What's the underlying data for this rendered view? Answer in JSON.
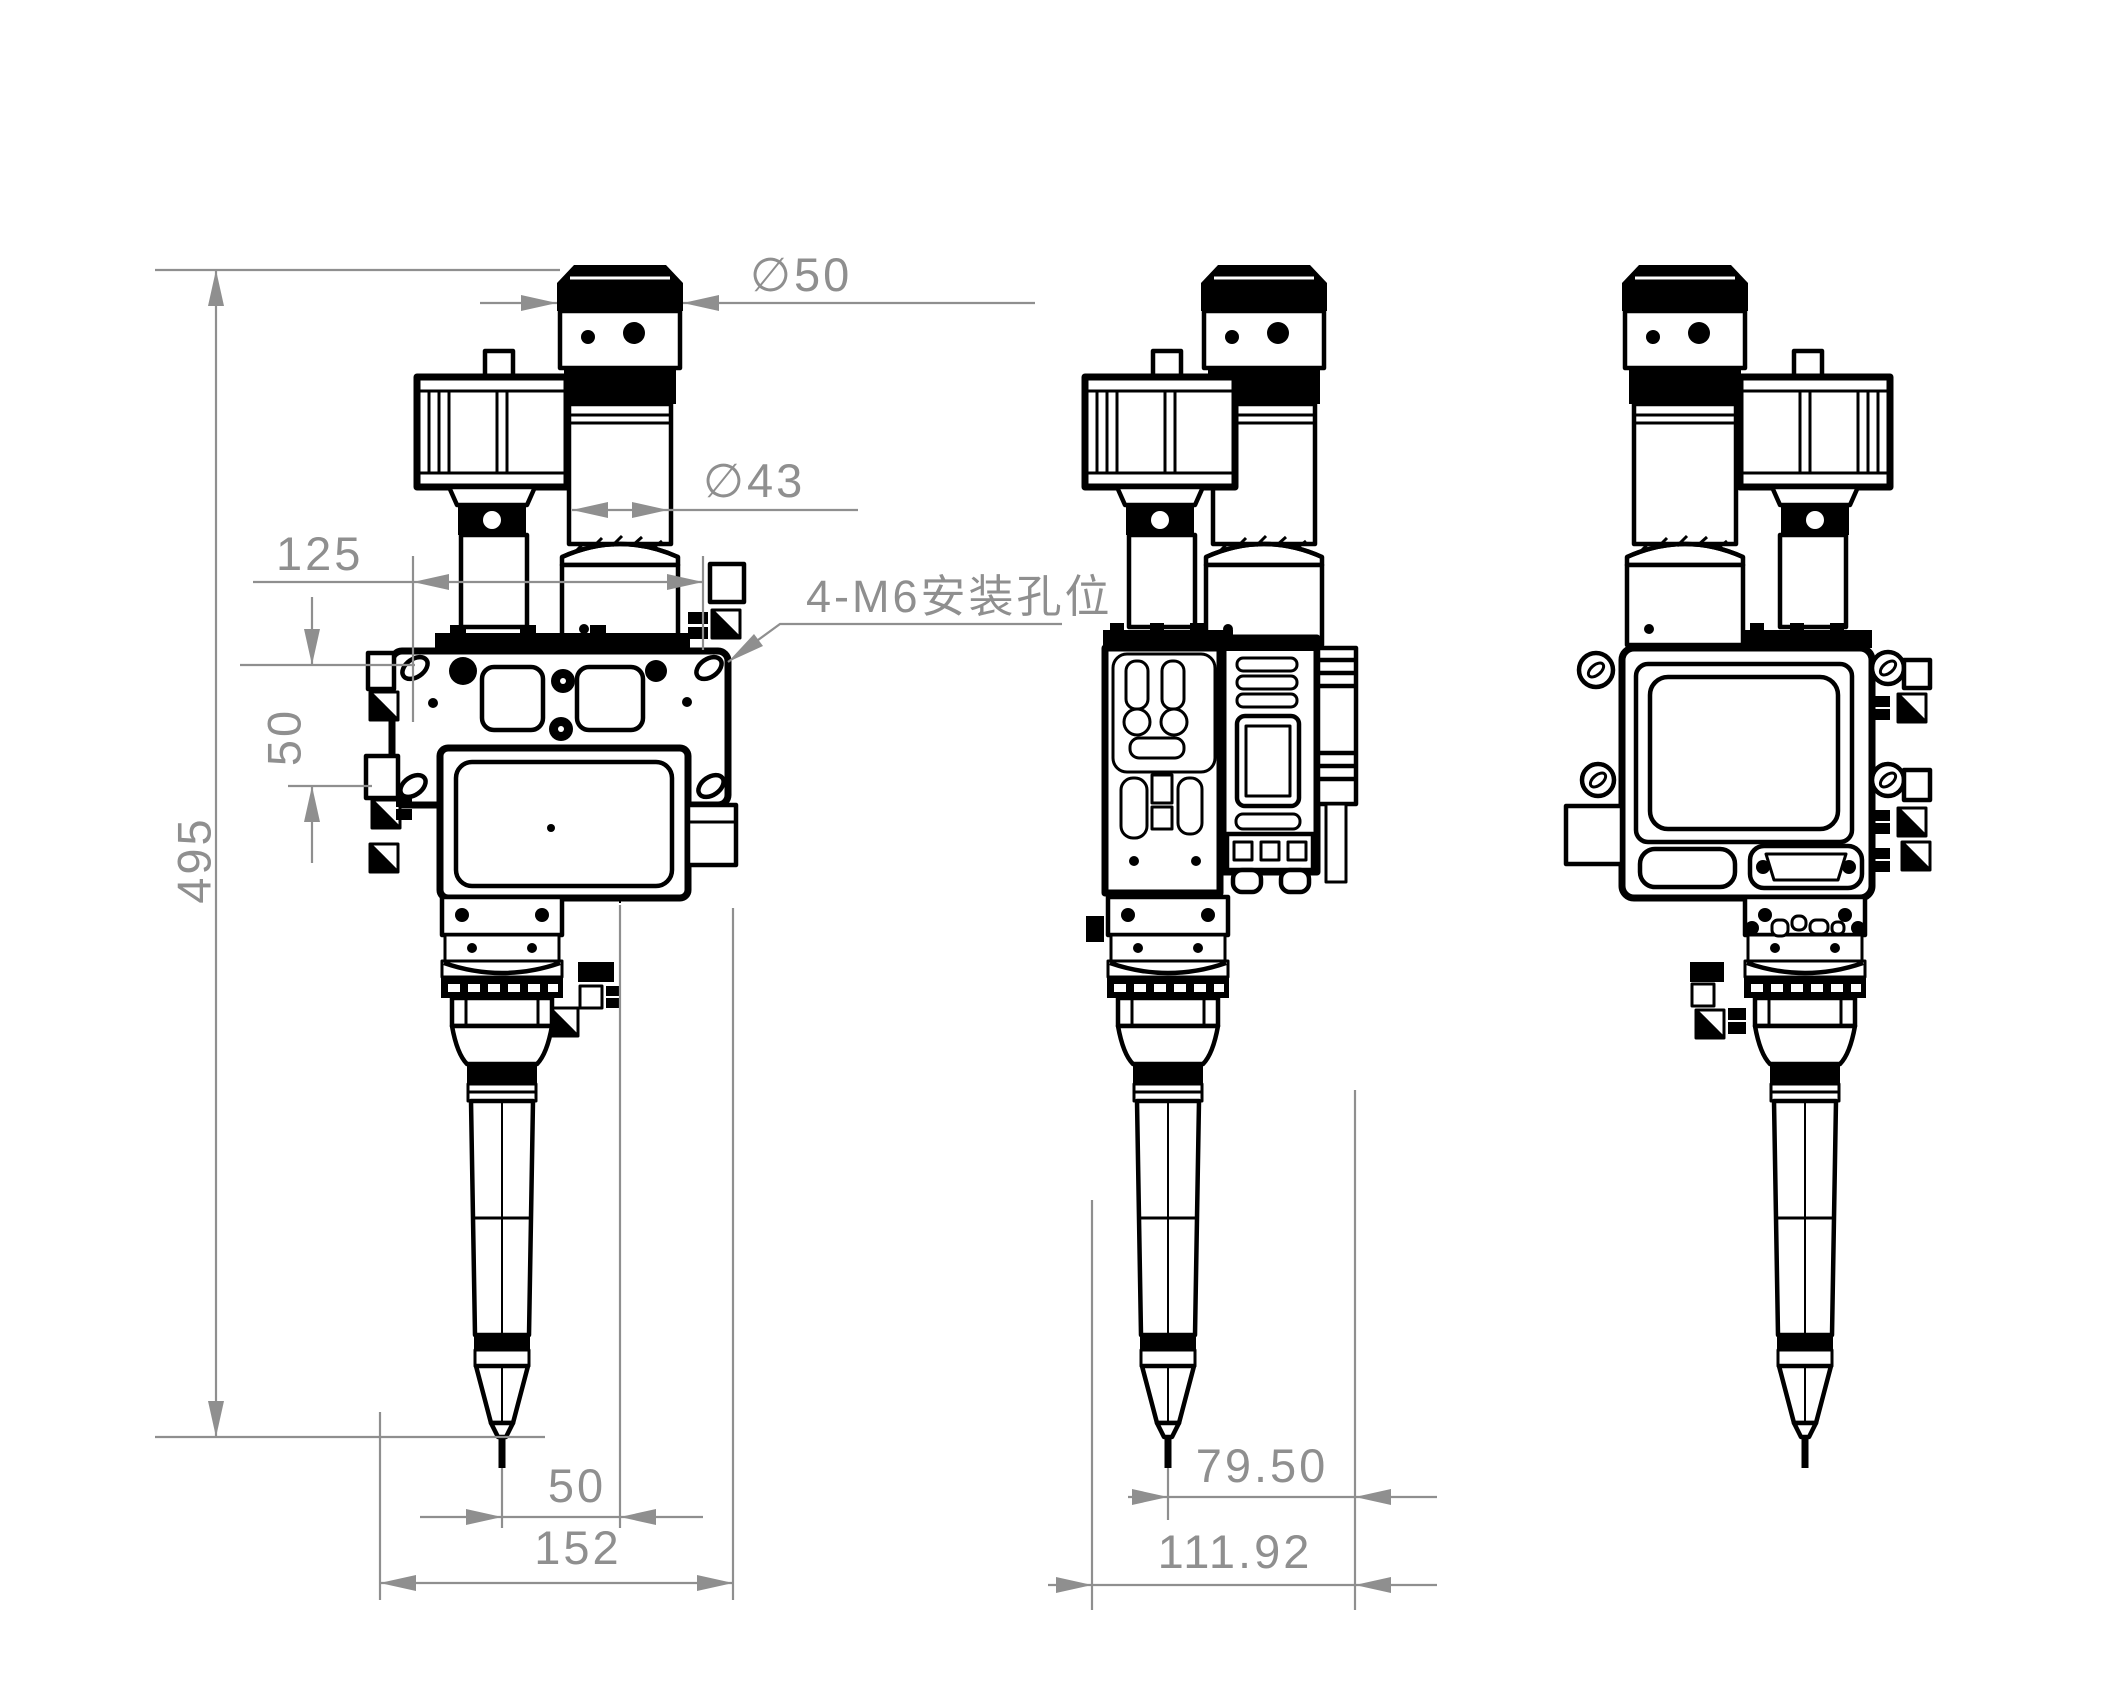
{
  "drawing": {
    "background_color": "#ffffff",
    "line_color": "#000000",
    "dimension_color": "#8f8f8f",
    "dimensions": {
      "front": {
        "camera_diameter": "∅50",
        "collimator_diameter": "∅43",
        "feeder_offset": "125",
        "hole_spacing": "50",
        "overall_height": "495",
        "nozzle_offset": "50",
        "overall_width": "152"
      },
      "side": {
        "nozzle_offset": "79.50",
        "overall_depth": "111.92"
      },
      "note_m6": "4-M6安装孔位"
    }
  }
}
